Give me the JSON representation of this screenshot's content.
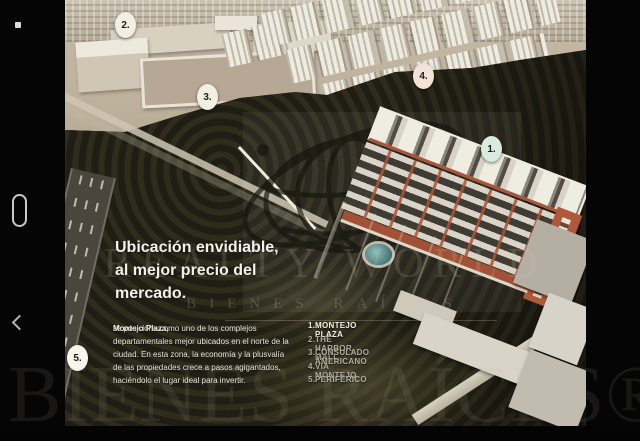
{
  "colors": {
    "marker_default": "#f2eee3",
    "marker_1_mint": "#d9eade",
    "marker_4_pink": "#f2e2d8",
    "marker_5_white": "#f7f5ee",
    "building_terracotta": "#b1583a",
    "headline_text": "#f4f1ea",
    "viewer_background": "#050505"
  },
  "slide": {
    "headline": "Ubicación envidiable,\nal mejor precio del\nmercado.",
    "body_lead": "Montejo Plaza,",
    "body_text": " se posiciona como uno de los complejos departamentales mejor ubicados en el norte de la ciudad. En esta zona, la economía y la plusvalía de las propiedades crece a pasos agigantados, haciéndolo el lugar ideal para invertir.",
    "legend": [
      {
        "num": "1.",
        "label": "MONTEJO PLAZA"
      },
      {
        "num": "2.",
        "label": "THE HARBOR MALL"
      },
      {
        "num": "3.",
        "label": "CONSULADO AMERICANO"
      },
      {
        "num": "4.",
        "label": "VIA MONTEJO"
      },
      {
        "num": "5.",
        "label": "PERIFÉRICO"
      }
    ],
    "markers": [
      {
        "label": "1."
      },
      {
        "label": "2."
      },
      {
        "label": "3."
      },
      {
        "label": "4."
      },
      {
        "label": "5."
      }
    ],
    "watermark": {
      "brand": "REALTY WORLD",
      "tagline": "BIENES RAÍCES",
      "giant": "BIENES RAÍCES®"
    }
  }
}
